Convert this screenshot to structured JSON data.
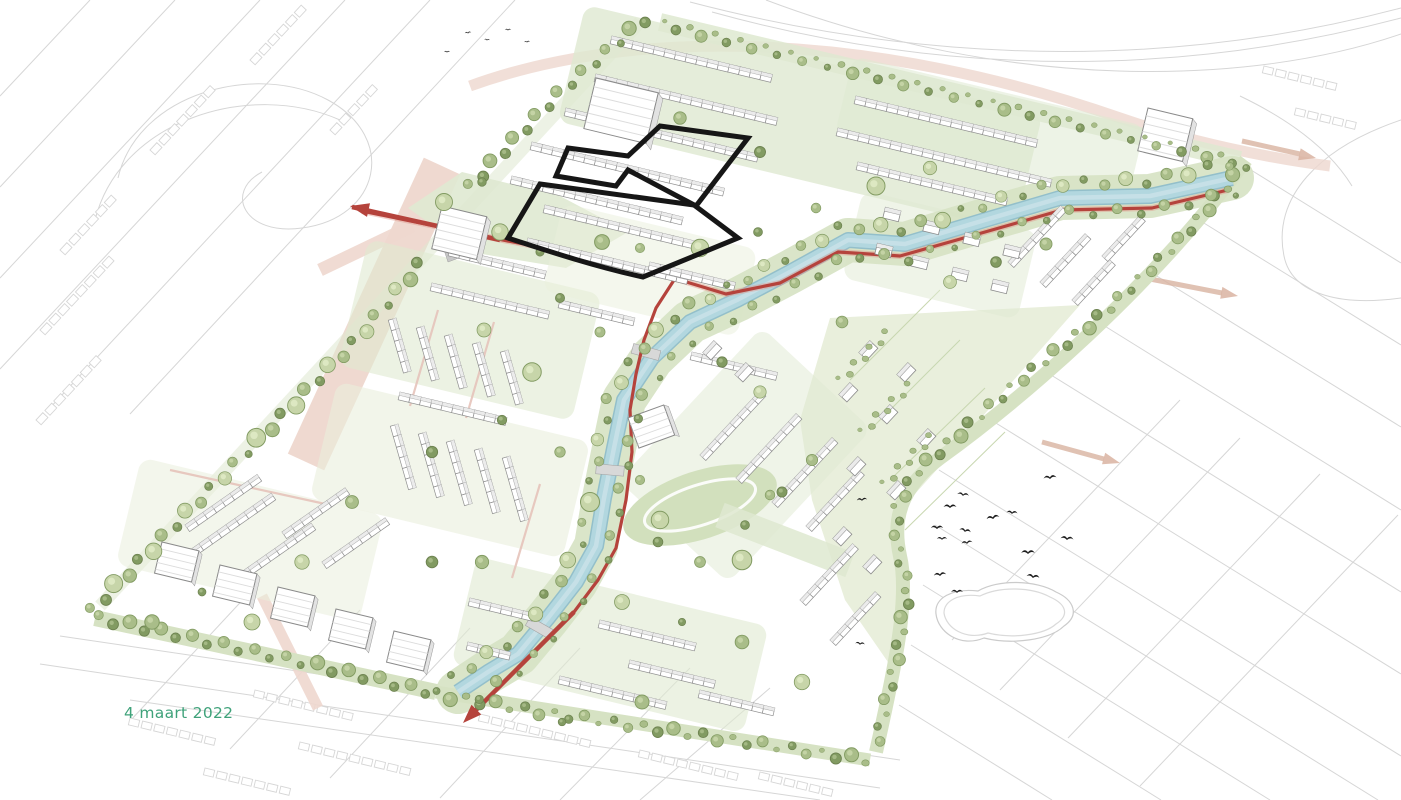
{
  "page": {
    "title": "stedenbouwkundig masterplan impressie",
    "date_label": "4 maart 2022"
  },
  "map": {
    "type": "masterplan-axonometric-illustration",
    "features": {
      "canal": "waterloop",
      "primary_route": "hoofdontsluiting",
      "highlight_plots": "plangebied contour",
      "context": "omgeving lijnenwerk",
      "pond": "vijver",
      "birds": "vogels"
    }
  },
  "palette": {
    "background": "#ffffff",
    "context_line": "#d6d6d6",
    "pink_road": "#eed7ce",
    "faint_arrow": "#d9b3a1",
    "red_route": "#b5433c",
    "red_route_light": "#e0968b",
    "canal": "#b2d7df",
    "canal_edge": "#93bfca",
    "canal_light": "#cfe4ea",
    "bank": "#d6e2c3",
    "park": "#dfe9d1",
    "meadow": "#e9efdc",
    "field": "#d2e0bd",
    "tree": "#a9bd89",
    "tree_dark": "#829b62",
    "tree_light": "#c7d5a9",
    "house_stroke": "#8f8f8f",
    "roof_shade": "#ebebeb",
    "building_gray": "#c2c2c2",
    "plaza_gray": "#c7c7c7",
    "bridge_gray": "#d8d8d8",
    "plot_outline": "#161616",
    "bird": "#1d1d1d",
    "pond_line": "#cbcbcb",
    "date_text": "#3fa27a"
  }
}
